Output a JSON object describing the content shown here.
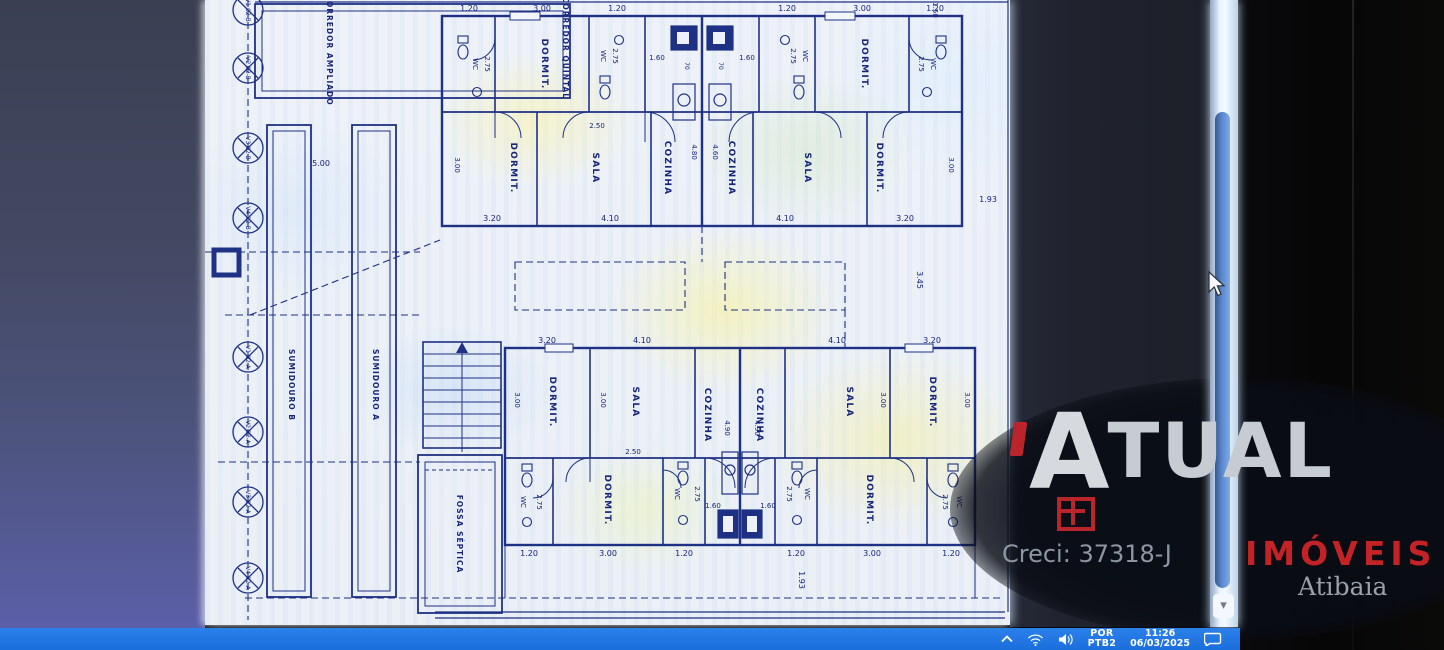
{
  "plan": {
    "rooms": {
      "dormit": "DORMIT.",
      "sala": "SALA",
      "cozinha": "COZINHA",
      "wc": "WC"
    },
    "dims": {
      "d070": "70",
      "d120": "1.20",
      "d150": "1.50",
      "d160": "1.60",
      "d193": "1.93",
      "d250": "2.50",
      "d275": "2.75",
      "d300": "3.00",
      "d320": "3.20",
      "d345": "3.45",
      "d410": "4.10",
      "d460": "4.60",
      "d480": "4.80",
      "d490": "4.90",
      "d500": "5.00"
    },
    "site": {
      "corridor_left": "CORREDOR AMPLIADO",
      "corridor_right": "CORREDOR QUINTAL",
      "sumidouro_b": "SUMIDOURO B",
      "sumidouro_a": "SUMIDOURO A",
      "fossa": "FOSSA SÉPTICA",
      "markers": [
        "V1 02-B",
        "V2 02-B",
        "V3 02-B",
        "V4 02-B",
        "V1 02-A",
        "V2 02-A",
        "V3 02-A",
        "V4 02-A"
      ]
    }
  },
  "watermark": {
    "brand_initial": "A",
    "brand_rest": "TUAL",
    "segment": "IMÓVEIS",
    "city": "Atibaia",
    "creci": "Creci: 37318-J"
  },
  "taskbar": {
    "language": "POR",
    "keyboard": "PTB2",
    "time": "11:26",
    "date": "06/03/2025"
  },
  "icons": {
    "scroll_down_glyph": "▾"
  },
  "colors": {
    "plan_line": "#1e3184",
    "taskbar_blue": "#1b6fdd",
    "watermark_red": "#b9252b",
    "thumb_blue": "#5b87ce"
  }
}
